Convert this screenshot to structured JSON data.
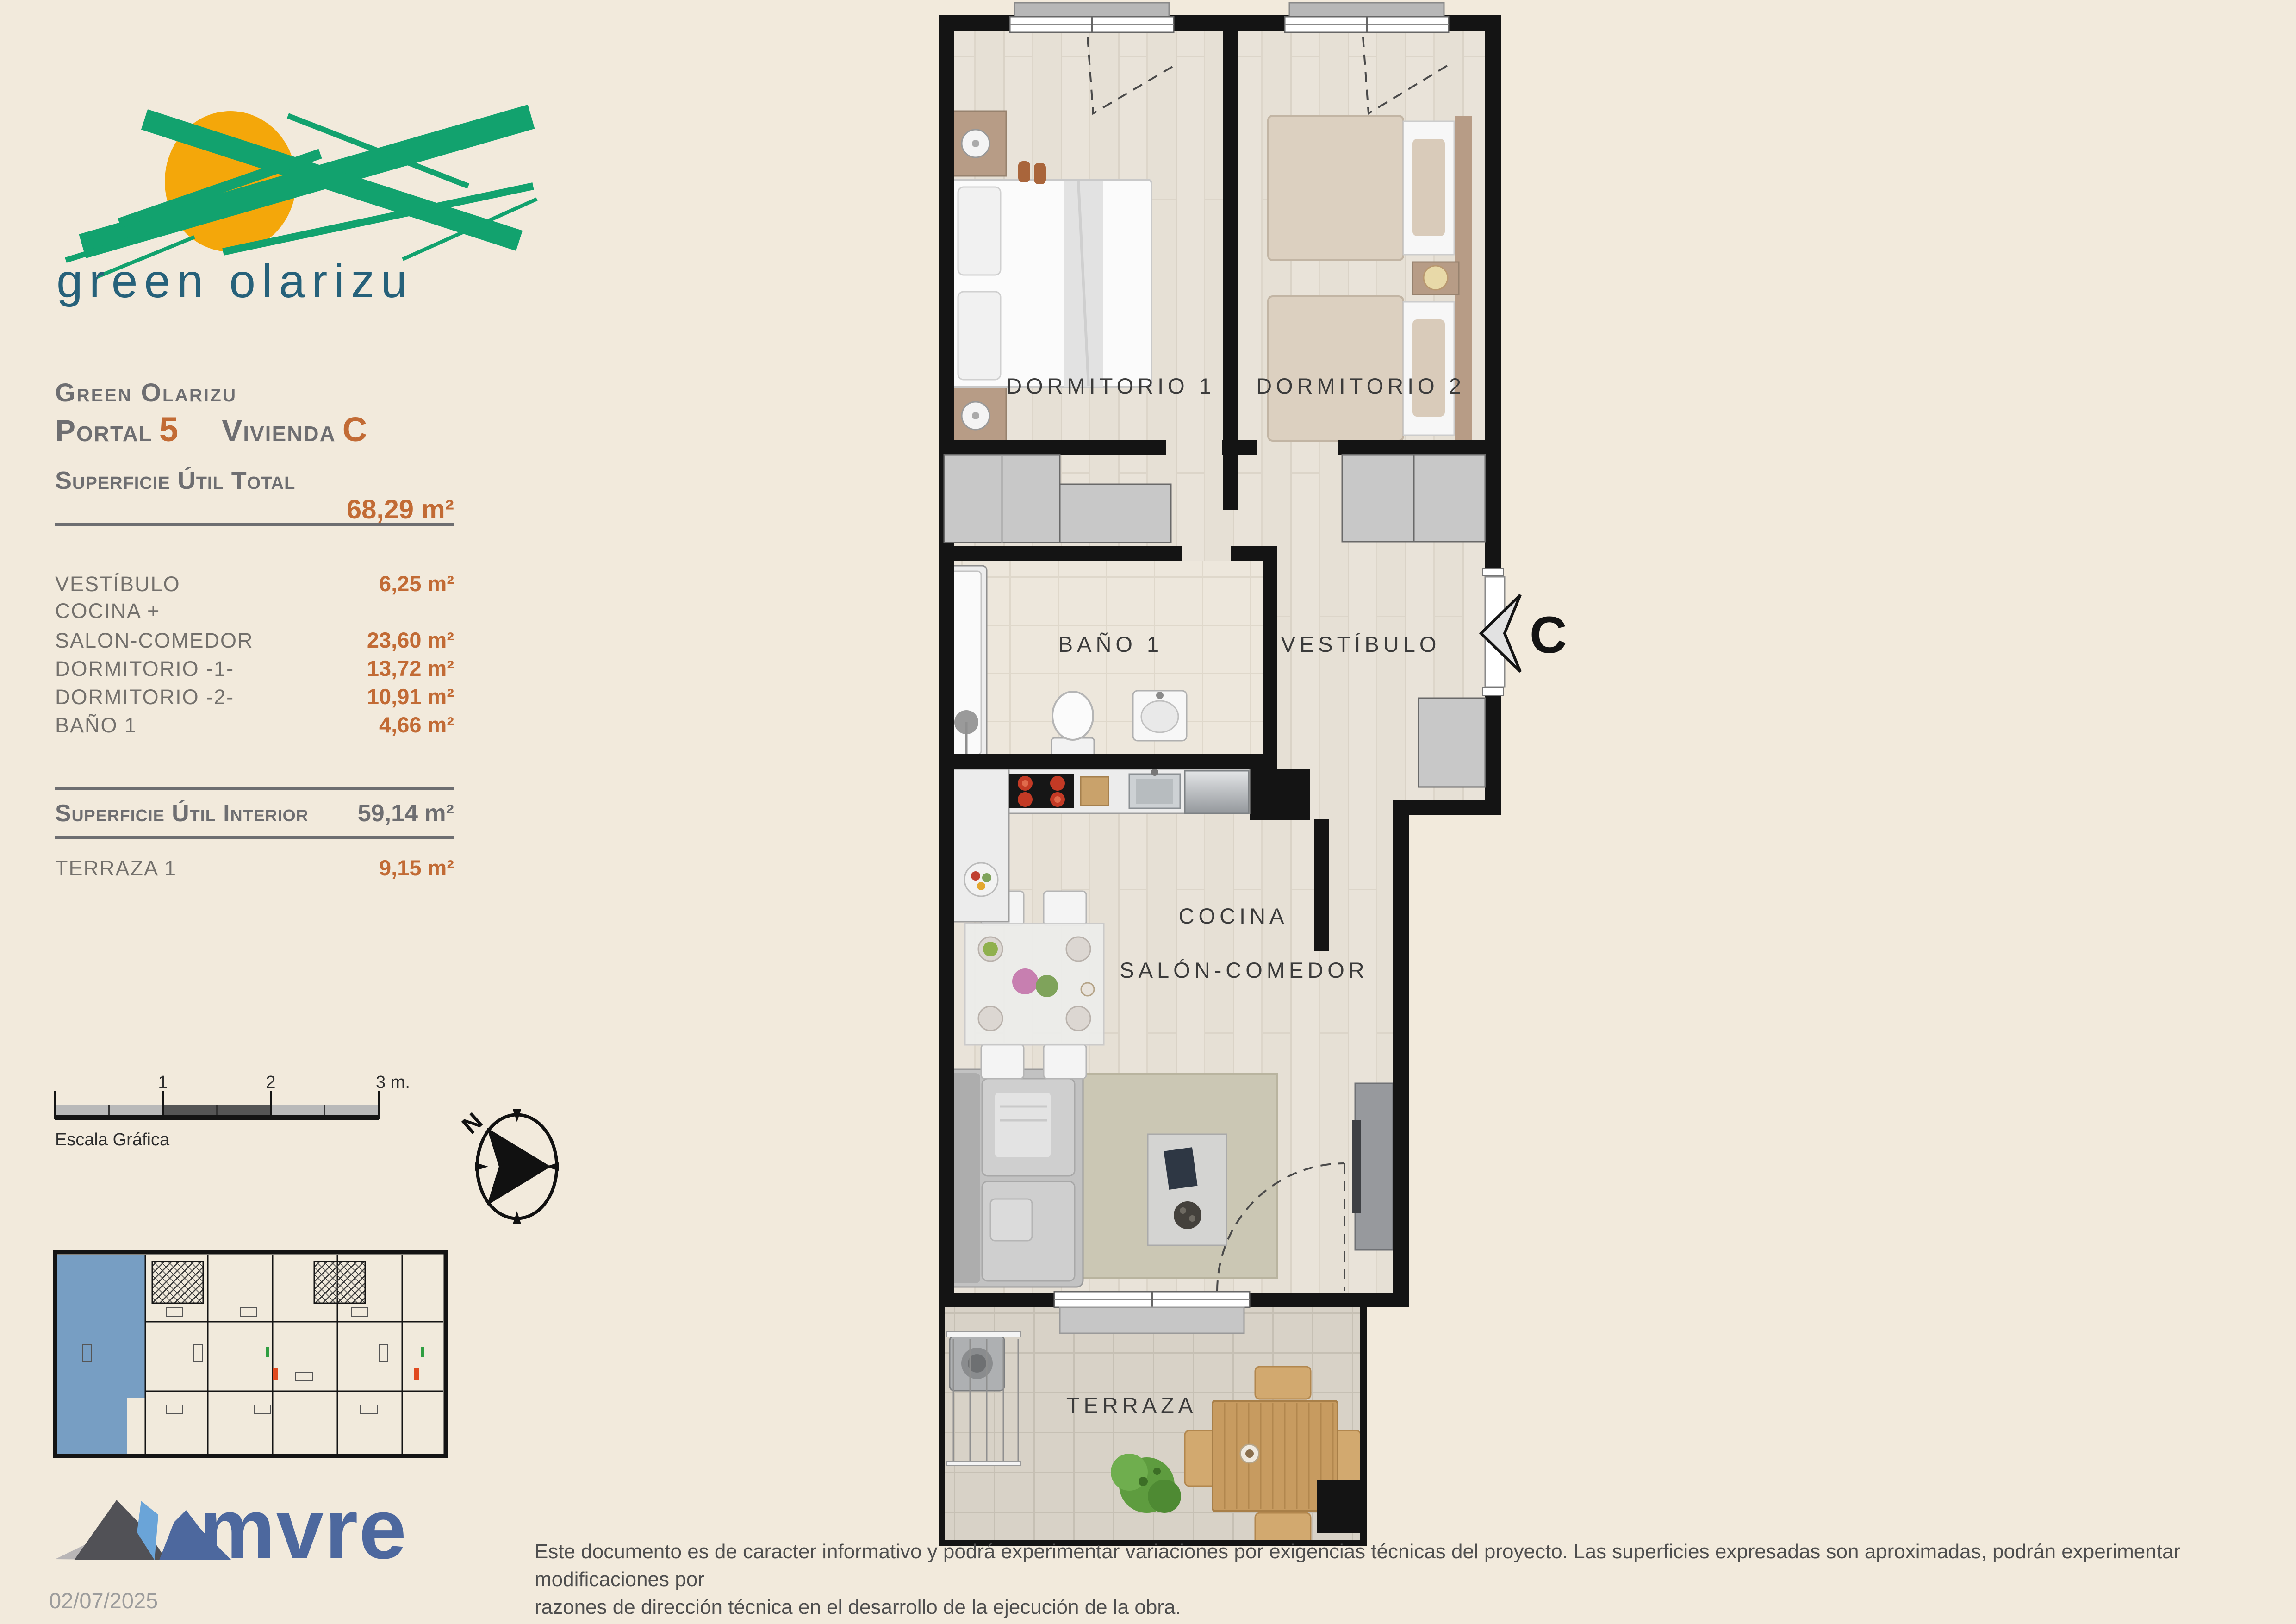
{
  "logo": {
    "brand": "green olarizu"
  },
  "title_block": {
    "project": "Green Olarizu",
    "portal_label": "Portal",
    "portal_value": "5",
    "vivienda_label": "Vivienda",
    "vivienda_value": "C",
    "total_label": "Superficie Útil Total",
    "total_value": "68,29 m²"
  },
  "surface_rows": [
    {
      "label": "VESTÍBULO",
      "value": "6,25 m²"
    },
    {
      "label": "COCINA +",
      "value": ""
    },
    {
      "label": "SALON-COMEDOR",
      "value": "23,60 m²"
    },
    {
      "label": "DORMITORIO -1-",
      "value": "13,72 m²"
    },
    {
      "label": "DORMITORIO -2-",
      "value": "10,91 m²"
    },
    {
      "label": "BAÑO 1",
      "value": "4,66 m²"
    }
  ],
  "interior_row": {
    "label": "Superficie Útil Interior",
    "value": "59,14 m²"
  },
  "terrace_row": {
    "label": "TERRAZA 1",
    "value": "9,15 m²"
  },
  "scale_bar": {
    "tick1": "1",
    "tick2": "2",
    "tick3": "3 m.",
    "label": "Escala Gráfica"
  },
  "compass": {
    "north": "N"
  },
  "plan": {
    "rooms": {
      "dorm1": "DORMITORIO 1",
      "dorm2": "DORMITORIO 2",
      "bath": "BAÑO 1",
      "hall": "VESTÍBULO",
      "kitchen": "COCINA",
      "living": "SALÓN-COMEDOR",
      "terrace": "TERRAZA"
    },
    "unit_marker": "C"
  },
  "footer": {
    "brand": "mvre",
    "date": "02/07/2025",
    "disclaimer_line1": "Este documento es de caracter informativo y podrá experimentar variaciones por exigencias técnicas del proyecto. Las superficies expresadas son aproximadas, podrán experimentar modificaciones por",
    "disclaimer_line2": "razones de dirección técnica en el desarrollo de la ejecución de la obra."
  },
  "colors": {
    "background": "#F2EADC",
    "accent_orange": "#C26B35",
    "heading_gray": "#6E6E71",
    "logo_green": "#12A26E",
    "logo_sun": "#F4A70A",
    "logo_text_teal": "#26617A",
    "mvre_blue": "#4D689E",
    "keyplan_highlight": "#6D97C0",
    "wall_black": "#141414"
  }
}
